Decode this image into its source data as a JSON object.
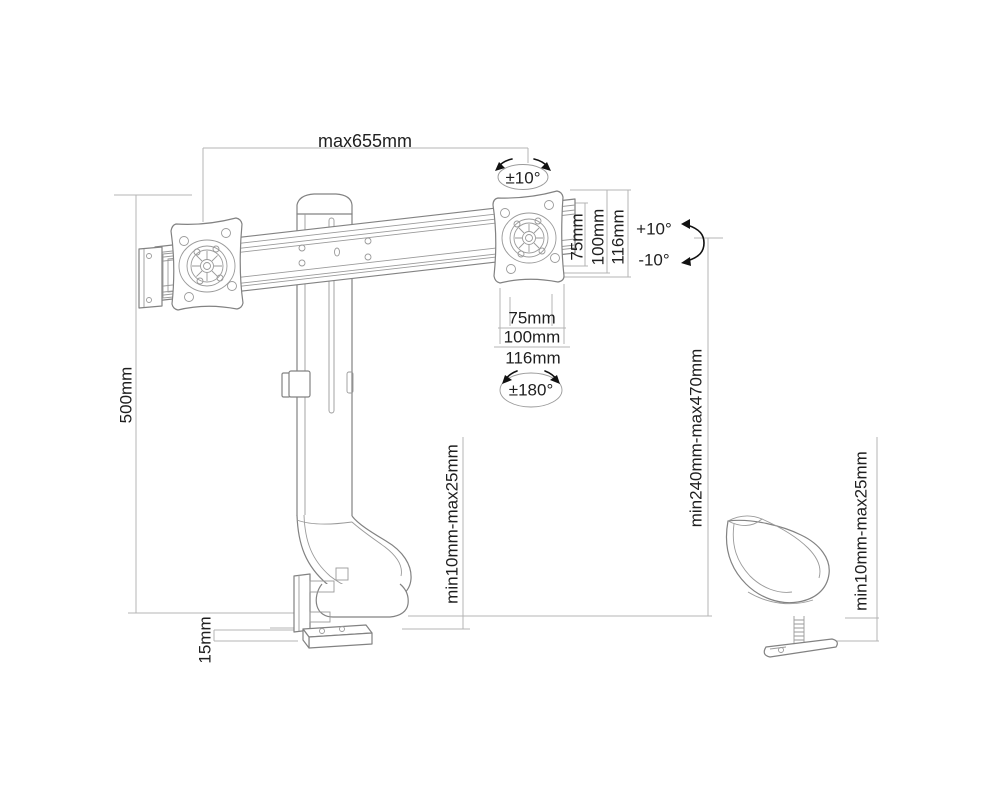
{
  "figure": {
    "type": "technical-dimension-drawing",
    "subject": "dual monitor desk mount arm with clamp and grommet base",
    "background": "#ffffff"
  },
  "labels": {
    "max_width": "max655mm",
    "swivel_top": "±10°",
    "plate_height_75": "75mm",
    "plate_height_100": "100mm",
    "plate_height_116": "116mm",
    "tilt_up": "+10°",
    "tilt_down": "-10°",
    "plate_width_75": "75mm",
    "plate_width_100": "100mm",
    "plate_width_116": "116mm",
    "rotation_range": "±180°",
    "column_height": "500mm",
    "height_adjust_range": "min240mm-max470mm",
    "desk_clamp_range": "min10mm-max25mm",
    "base_plate_thickness": "15mm",
    "grommet_clamp_range": "min10mm-max25mm"
  },
  "colors": {
    "outline": "#828282",
    "dimension_line": "#b4b4b4",
    "text": "#1f1f1f",
    "arrow": "#111111"
  }
}
